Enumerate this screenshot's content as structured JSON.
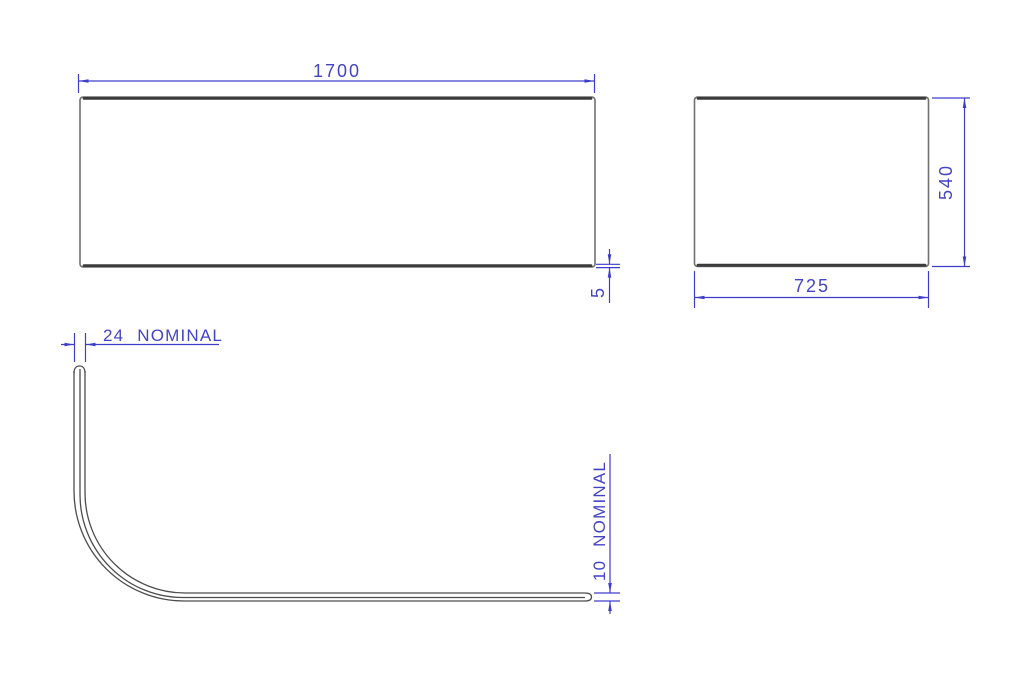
{
  "drawing": {
    "background": "#ffffff",
    "line_colors": {
      "dimension_blue": "#3d3dc9",
      "panel_edge_dark": "#3b3b3b",
      "panel_edge_light": "#717171",
      "profile_line": "#4d4d4d"
    },
    "front_view": {
      "width_dim": "1700",
      "edge_thickness_dim": "5"
    },
    "end_view": {
      "height_dim": "540",
      "width_dim": "725"
    },
    "profile_view": {
      "return_dim": "24 NOMINAL",
      "thickness_dim": "10 NOMINAL"
    }
  }
}
